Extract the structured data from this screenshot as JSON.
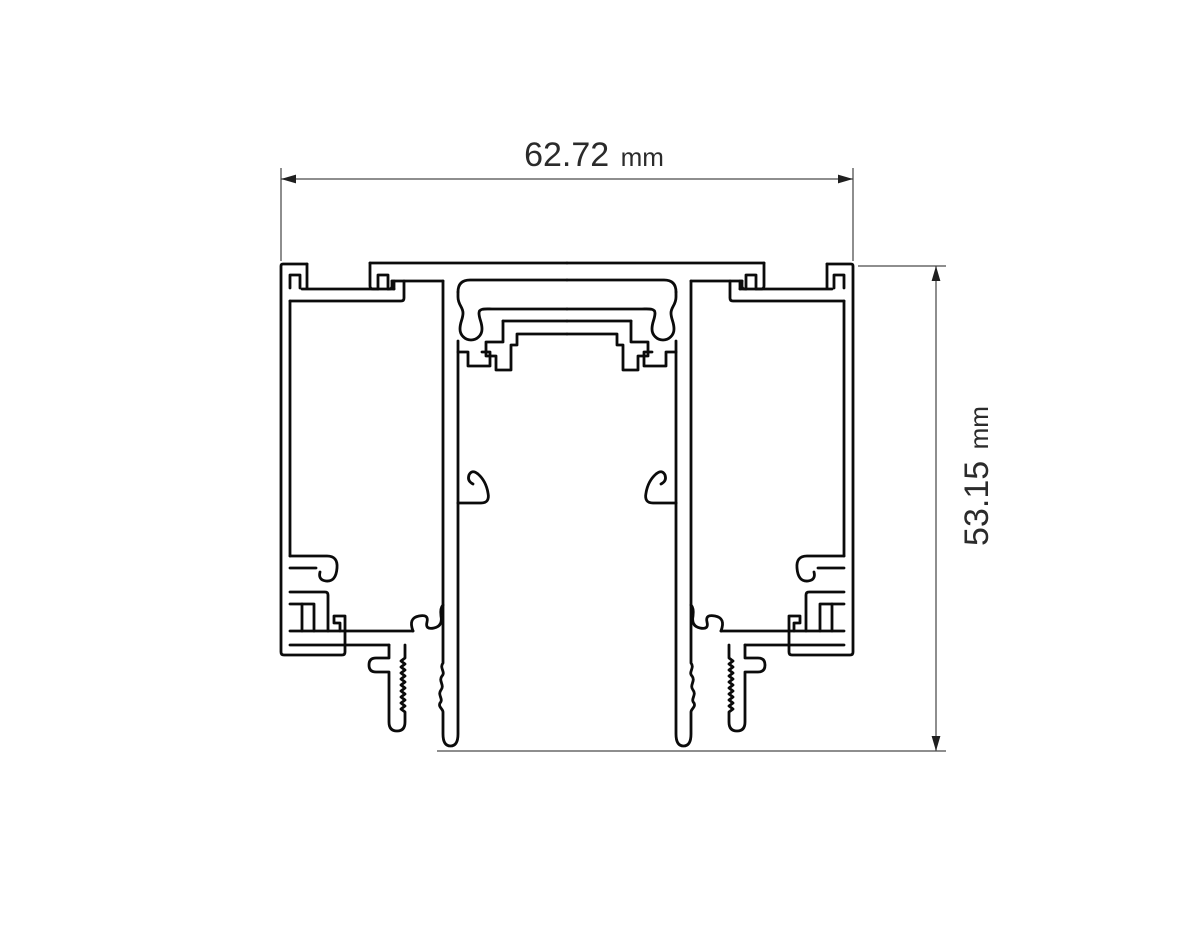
{
  "page": {
    "background": "#ffffff",
    "description": "Technical cross-section drawing of an aluminium recessed magnetic track profile with width and height dimensions"
  },
  "colors": {
    "profile_line": "#0b0b0b",
    "dimension_line": "#4a4a4a",
    "arrow": "#1f1f1f",
    "text": "#2b2b2b"
  },
  "dimensions": {
    "width": {
      "value": "62.72",
      "unit": "mm",
      "label": "62.72 mm",
      "orientation": "horizontal"
    },
    "height": {
      "value": "53.15",
      "unit": "mm",
      "label": "53.15 mm",
      "orientation": "vertical"
    }
  }
}
